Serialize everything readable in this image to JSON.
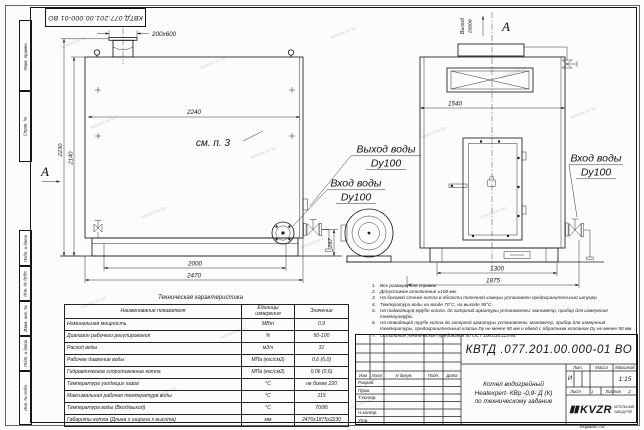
{
  "watermark": {
    "text": "kotelni-kv.kz"
  },
  "frame": {
    "top_stamp": "КВТД.077.201.00.000-01 ВО",
    "side_labels": [
      "Перв. примен.",
      "Справ. №",
      "Подп. и дата",
      "Инв. № дубл.",
      "Взам. инв. №",
      "Подп. и дата",
      "Инв. № подл."
    ],
    "format_label": "Формат А3"
  },
  "drawing": {
    "front_view": {
      "dim_chimney": "200х600",
      "dim_width_top": "2240",
      "dim_height_overall": "2230",
      "dim_height_body": "2140",
      "dim_base": "2000",
      "dim_length": "2470",
      "dim_pipe_height": "267",
      "see_item": "см. п. 3",
      "view_letter": "А"
    },
    "side_view": {
      "view_letter": "А",
      "gas_out_line1": "Выход",
      "gas_out_line2": "газов",
      "dim_width": "1540",
      "dim_base": "1300",
      "dim_overall": "1875"
    },
    "port_labels": {
      "water_out": "Выход воды",
      "water_out_dn": "Dy100",
      "water_in_front": "Вход воды",
      "water_in_front_dn": "Dy100",
      "water_in_side": "Вход воды",
      "water_in_side_dn": "Dy100"
    }
  },
  "tech_table": {
    "title": "Техническая характеристика",
    "headers": [
      "Наименование показателя",
      "Единицы измерения",
      "Значение"
    ],
    "rows": [
      {
        "name": "Номинальная мощность",
        "unit": "МВт",
        "value": "0,9"
      },
      {
        "name": "Диапазон рабочего регулирования",
        "unit": "%",
        "value": "50-100"
      },
      {
        "name": "Расход воды",
        "unit": "м3/ч",
        "value": "31"
      },
      {
        "name": "Рабочее давление воды",
        "unit": "МПа (кгс/см2)",
        "value": "0,6 (6,0)"
      },
      {
        "name": "Гидравлическое сопротивление котла",
        "unit": "МПа (кгс/см2)",
        "value": "0,06 (0,6)"
      },
      {
        "name": "Температура уходящих газов",
        "unit": "°С",
        "value": "не более 220"
      },
      {
        "name": "Максимальная рабочая температура воды",
        "unit": "°С",
        "value": "115"
      },
      {
        "name": "Температура воды (Вход/выход)",
        "unit": "°С",
        "value": "70/95"
      },
      {
        "name": "Габариты котла (Длина х ширина х высота)",
        "unit": "мм",
        "value": "2470х1875х2230"
      }
    ]
  },
  "notes": [
    {
      "n": "1.",
      "text": "Все размеры для справок"
    },
    {
      "n": "2.",
      "text": "Допустимое отклонение ±100 мм."
    },
    {
      "n": "3.",
      "text": "На боковой стенке котла в области топочной камеры установлен предохранительный штуцер"
    },
    {
      "n": "4.",
      "text": "Температура воды на входе 70°С, на выходе 95°С."
    },
    {
      "n": "5.",
      "text": "На подводящей трубе котла, до запорной арматуры установлены: манометр, прибор для измерения температуры."
    },
    {
      "n": "6.",
      "text": "На отводящей трубе котла до запорной арматуры установлены: манометр, прибор для измерения температуры, предохранительный клапан Dу не менее 50 мм и обвод с обратным клапаном Dу не менее 50 мм."
    },
    {
      "n": "7.",
      "text": "Остальные технические требования по ОСТ 108.030.113-84"
    }
  ],
  "title_block": {
    "doc_number": "КВТД .077.201.00.000-01  ВО",
    "product_line1": "Котел водогрейный",
    "product_line2": "Heatexpert- КВр -0,9- Д (К)",
    "product_line3": "по техническому задание",
    "cols": [
      "Изм",
      "Лист",
      "N докум.",
      "Подп.",
      "Дата"
    ],
    "sign_rows": [
      "Разраб.",
      "Пров.",
      "Т.контр.",
      "",
      "Н.контр.",
      "Утв."
    ],
    "lit_label": "Лит.",
    "mass_label": "Масса",
    "scale_label": "Масштаб",
    "lit_value": "И",
    "scale_value": "1:15",
    "sheet_label": "Лист",
    "sheet_value": "1",
    "sheets_label": "Листов",
    "sheets_value": "2",
    "logo_mark": "▮▮",
    "logo_text": "KVZR",
    "logo_sub1": "КОТЕЛЬНЫЙ",
    "logo_sub2": "ЗАВОД РЭП"
  }
}
